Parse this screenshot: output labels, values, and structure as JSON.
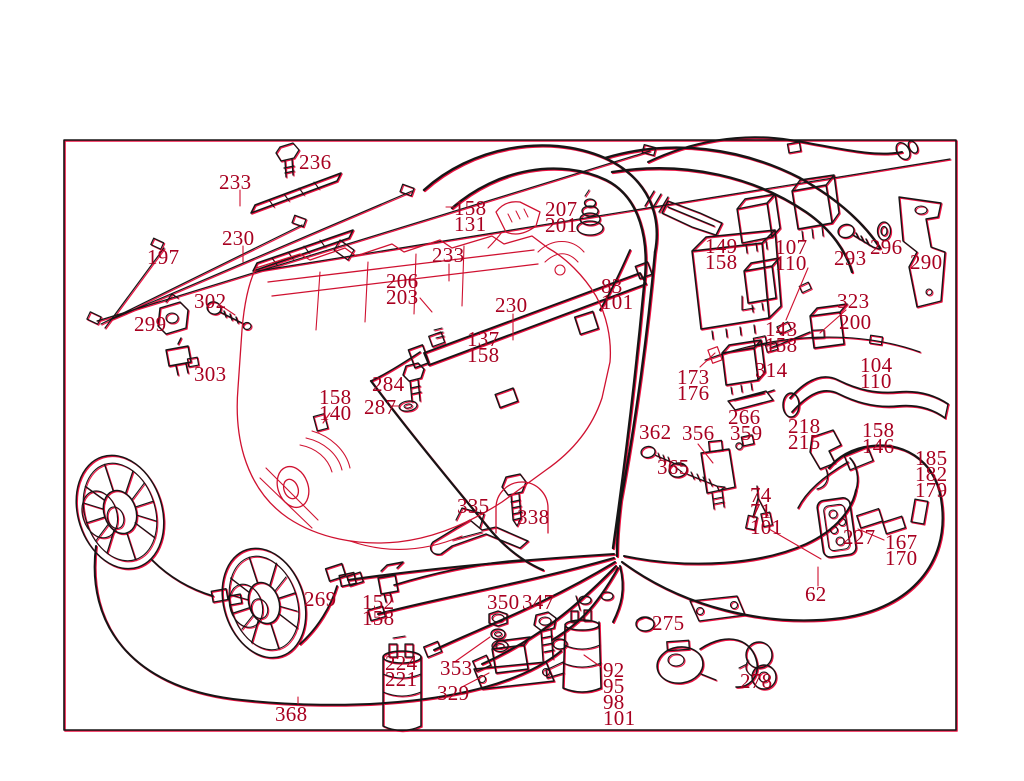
{
  "palette": {
    "background": "#ffffff",
    "line_black": "#161616",
    "line_red": "#cf1130",
    "accent_shadow": "#ef1243",
    "label_color": "#a80020"
  },
  "labels": [
    {
      "x": 299,
      "y": 154,
      "lines": [
        "236"
      ]
    },
    {
      "x": 219,
      "y": 174,
      "lines": [
        "233"
      ]
    },
    {
      "x": 222,
      "y": 230,
      "lines": [
        "230"
      ]
    },
    {
      "x": 147,
      "y": 249,
      "lines": [
        "197"
      ]
    },
    {
      "x": 454,
      "y": 200,
      "lines": [
        "158",
        "131"
      ]
    },
    {
      "x": 545,
      "y": 201,
      "lines": [
        "207",
        "201"
      ]
    },
    {
      "x": 432,
      "y": 247,
      "lines": [
        "233"
      ]
    },
    {
      "x": 386,
      "y": 273,
      "lines": [
        "206",
        "203"
      ]
    },
    {
      "x": 495,
      "y": 297,
      "lines": [
        "230"
      ]
    },
    {
      "x": 601,
      "y": 278,
      "lines": [
        "83",
        "101"
      ]
    },
    {
      "x": 705,
      "y": 238,
      "lines": [
        "149",
        "158"
      ]
    },
    {
      "x": 775,
      "y": 239,
      "lines": [
        "107",
        "110"
      ]
    },
    {
      "x": 834,
      "y": 250,
      "lines": [
        "293"
      ]
    },
    {
      "x": 870,
      "y": 239,
      "lines": [
        "296"
      ]
    },
    {
      "x": 910,
      "y": 254,
      "lines": [
        "290"
      ]
    },
    {
      "x": 194,
      "y": 293,
      "lines": [
        "302"
      ]
    },
    {
      "x": 134,
      "y": 316,
      "lines": [
        "299"
      ]
    },
    {
      "x": 194,
      "y": 366,
      "lines": [
        "303"
      ]
    },
    {
      "x": 837,
      "y": 293,
      "lines": [
        "323"
      ]
    },
    {
      "x": 839,
      "y": 314,
      "lines": [
        "200"
      ]
    },
    {
      "x": 765,
      "y": 321,
      "lines": [
        "143",
        "158"
      ]
    },
    {
      "x": 467,
      "y": 331,
      "lines": [
        "137",
        "158"
      ]
    },
    {
      "x": 372,
      "y": 376,
      "lines": [
        "284"
      ]
    },
    {
      "x": 364,
      "y": 399,
      "lines": [
        "287"
      ]
    },
    {
      "x": 319,
      "y": 389,
      "lines": [
        "158",
        "140"
      ]
    },
    {
      "x": 755,
      "y": 362,
      "lines": [
        "314"
      ]
    },
    {
      "x": 677,
      "y": 369,
      "lines": [
        "173",
        "176"
      ]
    },
    {
      "x": 860,
      "y": 357,
      "lines": [
        "104",
        "110"
      ]
    },
    {
      "x": 728,
      "y": 409,
      "lines": [
        "266"
      ]
    },
    {
      "x": 639,
      "y": 424,
      "lines": [
        "362"
      ]
    },
    {
      "x": 682,
      "y": 425,
      "lines": [
        "356"
      ]
    },
    {
      "x": 730,
      "y": 425,
      "lines": [
        "359"
      ]
    },
    {
      "x": 788,
      "y": 418,
      "lines": [
        "218",
        "215"
      ]
    },
    {
      "x": 862,
      "y": 422,
      "lines": [
        "158",
        "146"
      ]
    },
    {
      "x": 915,
      "y": 450,
      "lines": [
        "185",
        "182",
        "179"
      ]
    },
    {
      "x": 657,
      "y": 459,
      "lines": [
        "365"
      ]
    },
    {
      "x": 750,
      "y": 487,
      "lines": [
        "74",
        "71",
        "101"
      ]
    },
    {
      "x": 843,
      "y": 529,
      "lines": [
        "227"
      ]
    },
    {
      "x": 885,
      "y": 534,
      "lines": [
        "167",
        "170"
      ]
    },
    {
      "x": 457,
      "y": 498,
      "lines": [
        "335"
      ]
    },
    {
      "x": 517,
      "y": 509,
      "lines": [
        "338"
      ]
    },
    {
      "x": 805,
      "y": 586,
      "lines": [
        "62"
      ]
    },
    {
      "x": 304,
      "y": 591,
      "lines": [
        "269"
      ]
    },
    {
      "x": 362,
      "y": 594,
      "lines": [
        "152",
        "158"
      ]
    },
    {
      "x": 487,
      "y": 594,
      "lines": [
        "350"
      ]
    },
    {
      "x": 522,
      "y": 594,
      "lines": [
        "347"
      ]
    },
    {
      "x": 385,
      "y": 655,
      "lines": [
        "224",
        "221"
      ]
    },
    {
      "x": 440,
      "y": 660,
      "lines": [
        "353"
      ]
    },
    {
      "x": 437,
      "y": 685,
      "lines": [
        "329"
      ]
    },
    {
      "x": 652,
      "y": 615,
      "lines": [
        "275"
      ]
    },
    {
      "x": 603,
      "y": 662,
      "lines": [
        "92",
        "95",
        "98",
        "101"
      ]
    },
    {
      "x": 740,
      "y": 673,
      "lines": [
        "278"
      ]
    },
    {
      "x": 275,
      "y": 706,
      "lines": [
        "368"
      ]
    }
  ]
}
